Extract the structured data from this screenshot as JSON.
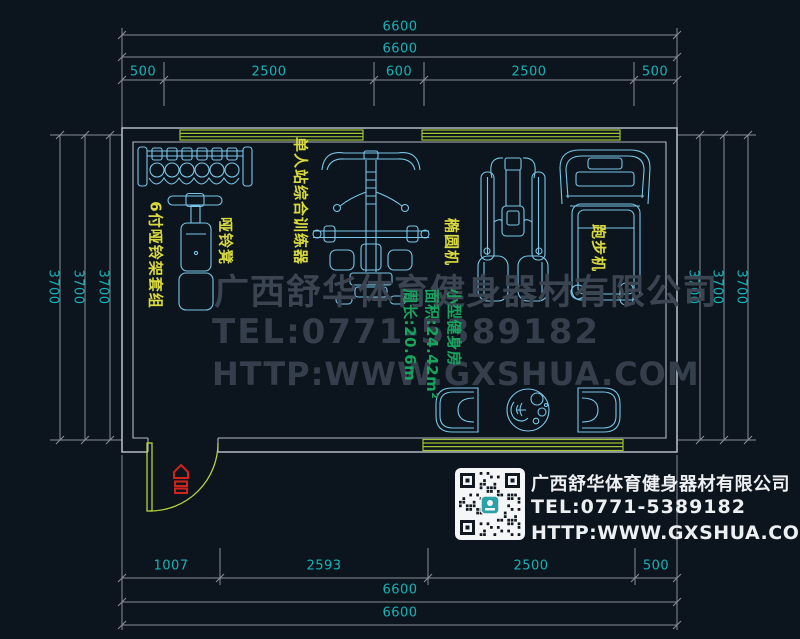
{
  "colors": {
    "background": "#0c141d",
    "wall": "#b4bac2",
    "dimension_line": "#878e96",
    "dimension_text": "#16b3b6",
    "equipment_line": "#79c6e6",
    "label_yellow": "#d9da3d",
    "window_green": "#9fc436",
    "door_green": "#b4d23c",
    "room_text_green": "#17a45f",
    "entrance_red": "#d2231d",
    "watermark_gray": "#3b4551",
    "contact_text": "#edf0f2"
  },
  "dimensions": {
    "top": {
      "overall_1": "6600",
      "overall_2": "6600",
      "segments": [
        "500",
        "2500",
        "600",
        "2500",
        "500"
      ]
    },
    "bottom": {
      "segments": [
        "1007",
        "2593",
        "2500",
        "500"
      ],
      "overall_1": "6600",
      "overall_2": "6600"
    },
    "left": {
      "values": [
        "3700",
        "3700",
        "3700"
      ]
    },
    "right": {
      "values": [
        "3700",
        "3700",
        "3700"
      ]
    }
  },
  "room_label": {
    "name": "小型健身房",
    "area": "面积:24.42m²",
    "perimeter": "周长:20.6m"
  },
  "equipment_labels": {
    "dumbbell_rack": "6付哑铃架套组",
    "dumbbell_bench": "哑铃凳",
    "multi_gym": "单人站综合训练器",
    "elliptical": "椭圆机",
    "treadmill": "跑步机"
  },
  "watermark": {
    "company": "广西舒华体育健身器材有限公司",
    "tel": "TEL:0771-5389182",
    "website": "HTTP:WWW.GXSHUA.COM"
  },
  "contact": {
    "company": "广西舒华体育健身器材有限公司",
    "tel": "TEL:0771-5389182",
    "website": "HTTP:WWW.GXSHUA.COM"
  }
}
